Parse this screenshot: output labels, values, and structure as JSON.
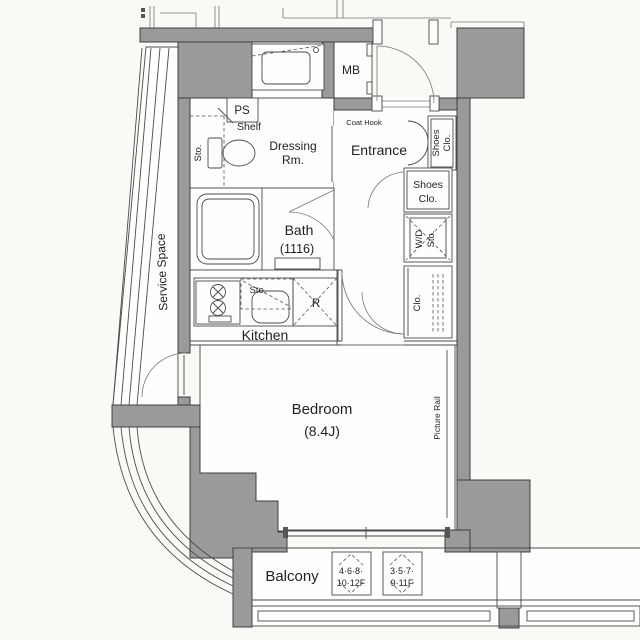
{
  "colors": {
    "background": "#faf9f6",
    "wall_fill": "#9a9a9a",
    "wall_stroke": "#3e3e3e",
    "line": "#4a4a4a",
    "text": "#1f1f1f"
  },
  "rooms": {
    "service_space": {
      "label": "Service Space"
    },
    "dressing_room": {
      "label_line1": "Dressing",
      "label_line2": "Rm."
    },
    "entrance": {
      "label": "Entrance"
    },
    "bath": {
      "label": "Bath",
      "size": "(1116)"
    },
    "kitchen": {
      "label": "Kitchen"
    },
    "bedroom": {
      "label": "Bedroom",
      "size": "(8.4J)"
    },
    "balcony": {
      "label": "Balcony"
    }
  },
  "fixtures": {
    "pipe_space": {
      "label": "PS"
    },
    "shelf": {
      "label": "Shelf"
    },
    "storage_dressing": {
      "label": "Sto."
    },
    "meter_box": {
      "label": "MB"
    },
    "coat_hook": {
      "label": "Coat Hook"
    },
    "shoes_closet_upper": {
      "label_line1": "Shoes",
      "label_line2": "Clo."
    },
    "shoes_closet_lower": {
      "label_line1": "Shoes",
      "label_line2": "Clo."
    },
    "washer_dryer_storage": {
      "label_line1": "W/D",
      "label_line2": "Sto."
    },
    "closet": {
      "label": "Clo."
    },
    "storage_kitchen": {
      "label": "Sto."
    },
    "refrigerator_space": {
      "label": "R"
    },
    "picture_rail": {
      "label": "Picture Rail"
    }
  },
  "balcony_hatches": [
    {
      "line1": "4·6·8·",
      "line2": "10·12F"
    },
    {
      "line1": "3·5·7·",
      "line2": "9·11F"
    }
  ]
}
